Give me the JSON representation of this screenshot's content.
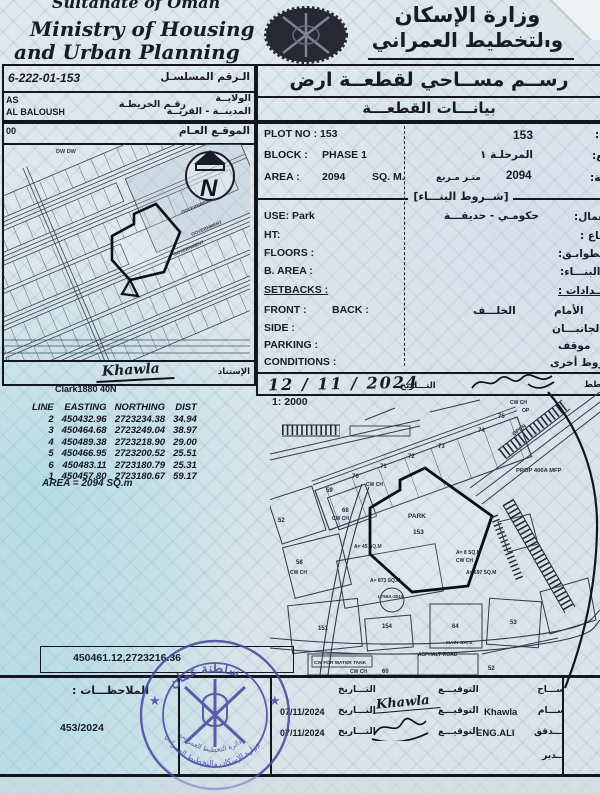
{
  "header": {
    "country_en": "Sultanate of Oman",
    "ministry_en_line1": "Ministry of Housing",
    "ministry_en_line2": "and Urban Planning",
    "ministry_ar_line1": "وزارة الإسكان",
    "ministry_ar_line2": "والتخطيط العمراني"
  },
  "ref": {
    "serial_value": "6-222-01-153",
    "serial_label_ar": "الـرقم المسلسـل",
    "wilaya_value": "AS",
    "wilaya_label_ar": "الولايــة",
    "village_value": "AL BALOUSH",
    "map_no_label_ar": "رقـم الخريطـة",
    "village_label_ar": "المدينــة - القريــة",
    "sheet_no_partial": "00"
  },
  "title": {
    "main_ar": "رســم مســاحي لقطعــة ارض",
    "sub_ar": "بيانـــات القطعـــة"
  },
  "location_map": {
    "header_ar": "الموقـع العـام",
    "dw_label": "DW  DW",
    "government_label": "GOVERNMENT",
    "north_letter": "N",
    "surveyor_sig": "Khawla",
    "datum_label_ar": "الإستناد",
    "datum": "Clark1880 40N"
  },
  "plot": {
    "plot_no_label": "PLOT NO : ",
    "plot_no": "153",
    "plot_no_ar": "153",
    "plot_no_label_ar": "رقم القطعة:",
    "block_label": "BLOCK :",
    "block": "PHASE 1",
    "block_ar": "المرحلـة ١",
    "block_label_ar": "المربع:",
    "area_label": "AREA :",
    "area": "2094",
    "area_unit": "SQ. M.",
    "area_unit_ar": "متـر مـربع",
    "area_ar": "2094",
    "area_label_ar": "المساحة:",
    "building_header_ar": "[شــروط البنـــاء]",
    "use_label": "USE:  Park",
    "use_ar": "حكومـي - حديقـــة",
    "use_label_ar": "الاستعمال:",
    "ht_label": "HT:",
    "ht_label_ar": "الارتفـــاع :",
    "floors_label": "FLOORS :",
    "floors_label_ar": "عدد الطوابـق:",
    "barea_label": "B. AREA :",
    "barea_label_ar": "نسبة البنـــاء:",
    "setbacks_label": "SETBACKS :",
    "setbacks_label_ar": "الارتـــدادات :",
    "front_label": "FRONT :",
    "back_label": "BACK :",
    "back_ar": "الخلـــف",
    "front_ar": "الأمام",
    "side_label": "SIDE :",
    "side_ar": "الجانبـــان",
    "parking_label": "PARKING :",
    "parking_ar": "موقف",
    "conditions_label": "CONDITIONS :",
    "conditions_ar": "شروط أخرى",
    "date_value": "12 / 11 / 2024",
    "date_label_ar": "التـــاريخ",
    "planner_label_ar": "المخطط",
    "scale": "1: 2000"
  },
  "coords_table": {
    "headers": [
      "LINE",
      "EASTING",
      "NORTHING",
      "DIST"
    ],
    "rows": [
      [
        "2",
        "450432.96",
        "2723234.38",
        "34.94"
      ],
      [
        "3",
        "450464.68",
        "2723249.04",
        "38.97"
      ],
      [
        "4",
        "450489.38",
        "2723218.90",
        "29.00"
      ],
      [
        "5",
        "450466.95",
        "2723200.52",
        "25.51"
      ],
      [
        "6",
        "450483.11",
        "2723180.79",
        "25.31"
      ],
      [
        "1",
        "450457.80",
        "2723180.67",
        "59.17"
      ]
    ],
    "area_note": "AREA = 2094  SQ.m"
  },
  "site_plan": {
    "plots_top": [
      "70",
      "71",
      "72",
      "73",
      "74",
      "75"
    ],
    "plot_59": "59",
    "plot_68": "68",
    "plot_52": "52",
    "plot_58": "58",
    "plot_151": "151",
    "plot_154": "154",
    "plot_64": "64",
    "plot_53": "53",
    "plot_60": "60",
    "plot_52b": "52",
    "park_label": "PARK",
    "park_no": "153",
    "cw_ch": "CW CH",
    "open_label": "OPEN",
    "prop_label": "PROP 400A MFP",
    "area_873": "A= 873 SQ.M",
    "area_697": "A= 697 SQ.M",
    "area_45": "A= 45 SQ.M",
    "area_8": "A= 8 SQ.M",
    "lt_label": "LT56A-2019",
    "main_gate": "MAIN GATE",
    "asphalt_road": "ASPHALT ROAD",
    "water_tank": "CW FOR WATER TANK"
  },
  "center_coordinate": "450461.12,2723216.36",
  "footer": {
    "notes_label_ar": "الملاحظـــات :",
    "doc_no": "453/2024",
    "sig_label_ar": "التوقيـــع",
    "date_label_ar": "التـــاريخ",
    "row_surveyor_role_ar": "المســـاح",
    "row_draughtsman_role_ar": "الرســـام",
    "row_draughtsman_name": "Khawla",
    "row_draughtsman_sig": "Khawla",
    "row_draughtsman_date": "07/11/2024",
    "row_checker_role_ar": "المــــدقق",
    "row_checker_name": "ENG.ALI",
    "row_checker_date": "07/11/2024",
    "row_director_role_ar": "المـــدير"
  },
  "stamp": {
    "top_ar": "سلطنة عمان",
    "ring_ar": "وزارة الإسكان والتخطيط العمراني",
    "bottom_ar": "دائرة التخطيط العمراني"
  },
  "colors": {
    "paper": "#dfe9ed",
    "ink": "#14161f",
    "stamp_blue": "#4a4aa0",
    "teal_tint": "#6ec8d7"
  }
}
